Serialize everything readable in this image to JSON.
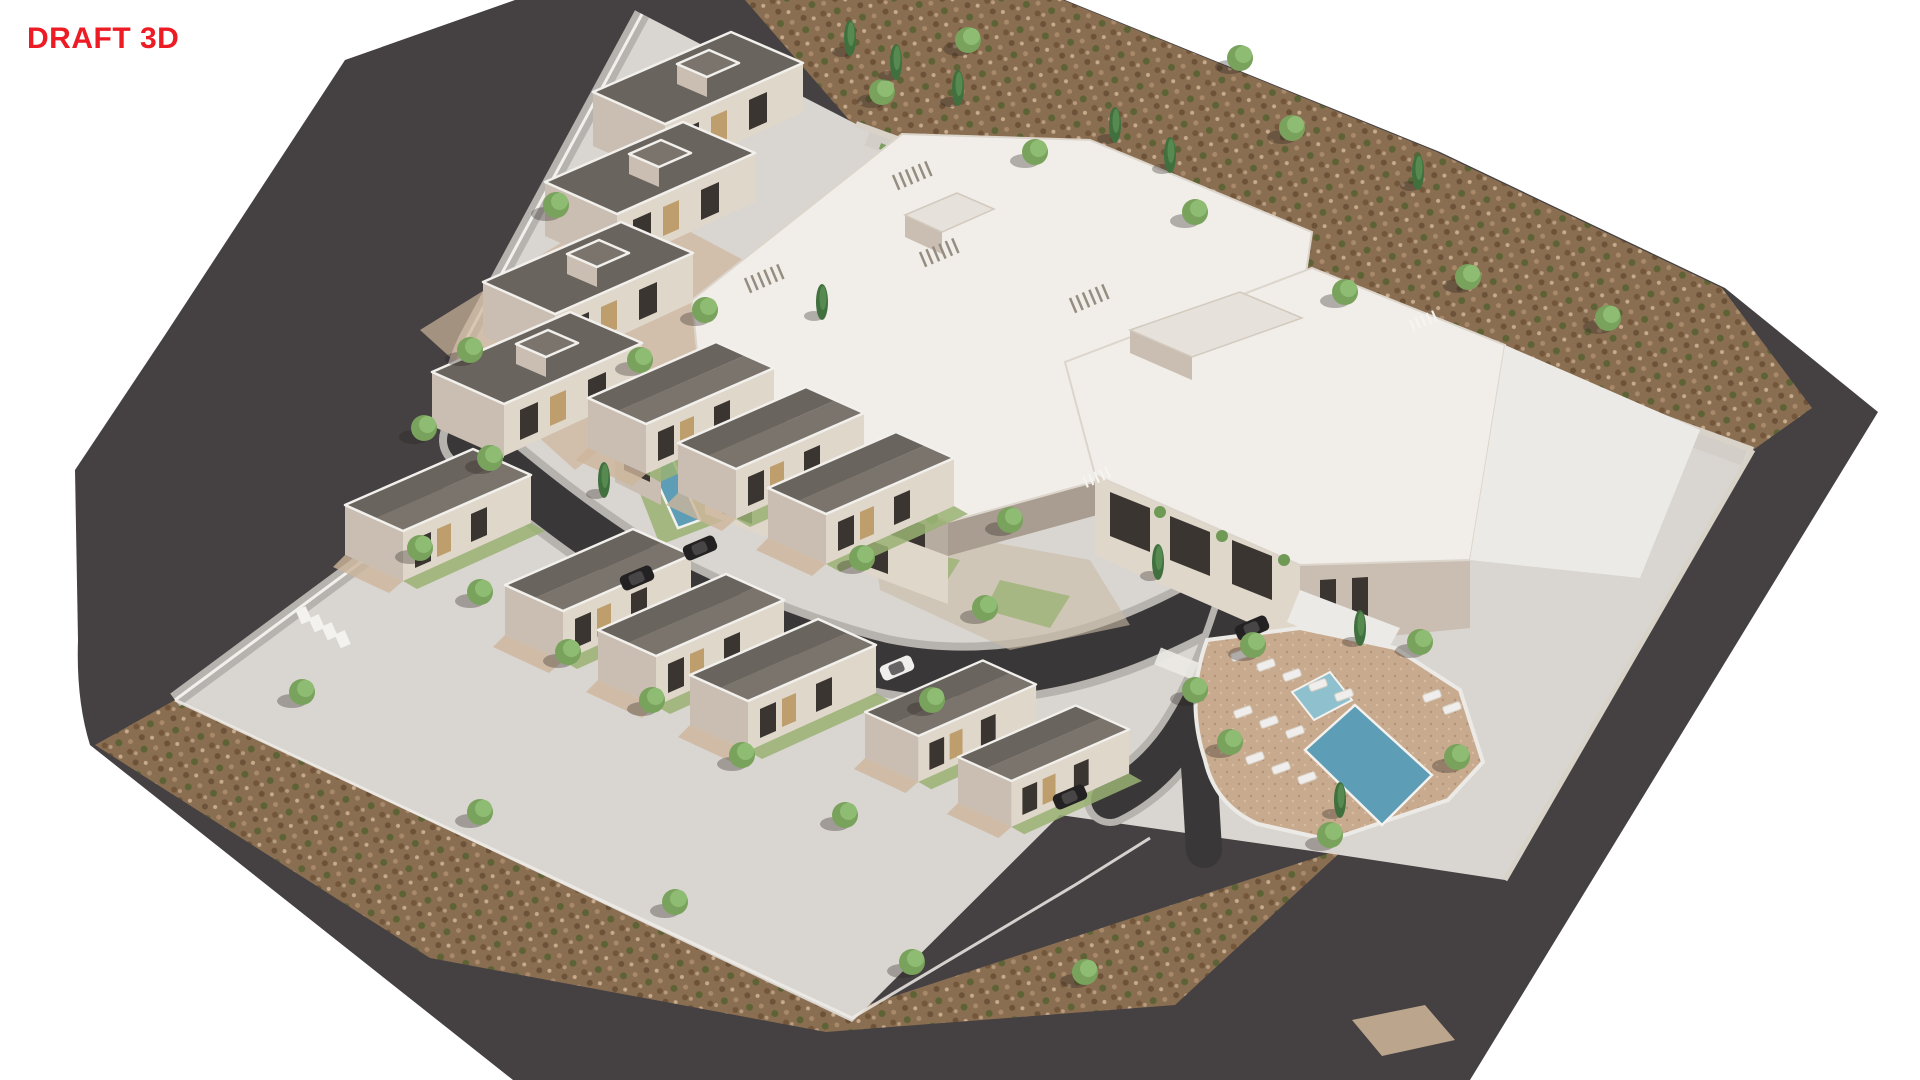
{
  "watermark": {
    "label": "DRAFT 3D",
    "color": "#EC1B24"
  },
  "scene": {
    "type": "3d-architectural-site-render",
    "view": "aerial-axonometric",
    "elements": {
      "apartment_buildings": 2,
      "villas": 13,
      "lap_pools": 3,
      "communal_pool": 1,
      "kids_pool": 1,
      "sun_loungers": 13,
      "cars": 5
    },
    "villas_large": [
      [
        593,
        92
      ],
      [
        545,
        182
      ],
      [
        483,
        282
      ],
      [
        432,
        372
      ]
    ],
    "villas_row": [
      [
        345,
        505,
        1
      ],
      [
        505,
        585,
        1
      ],
      [
        598,
        630,
        1
      ],
      [
        690,
        675,
        1
      ],
      [
        865,
        712,
        0.92
      ],
      [
        958,
        757,
        0.92
      ],
      [
        588,
        398,
        1
      ],
      [
        678,
        443,
        1
      ],
      [
        768,
        488,
        1
      ]
    ],
    "trees": [
      [
        882,
        92
      ],
      [
        1035,
        152
      ],
      [
        1195,
        212
      ],
      [
        1292,
        128
      ],
      [
        1345,
        292
      ],
      [
        1468,
        277
      ],
      [
        1608,
        318
      ],
      [
        1240,
        58
      ],
      [
        968,
        40
      ],
      [
        556,
        205
      ],
      [
        470,
        350
      ],
      [
        424,
        428
      ],
      [
        490,
        458
      ],
      [
        420,
        548
      ],
      [
        480,
        592
      ],
      [
        568,
        652
      ],
      [
        652,
        700
      ],
      [
        742,
        755
      ],
      [
        845,
        815
      ],
      [
        302,
        692
      ],
      [
        480,
        812
      ],
      [
        675,
        902
      ],
      [
        912,
        962
      ],
      [
        1085,
        972
      ],
      [
        1253,
        645
      ],
      [
        1420,
        642
      ],
      [
        1457,
        757
      ],
      [
        1230,
        742
      ],
      [
        1195,
        690
      ],
      [
        985,
        608
      ],
      [
        932,
        700
      ],
      [
        1010,
        520
      ],
      [
        862,
        558
      ],
      [
        1330,
        835
      ],
      [
        705,
        310
      ],
      [
        640,
        360
      ]
    ],
    "cypresses": [
      [
        850,
        38
      ],
      [
        896,
        62
      ],
      [
        1115,
        125
      ],
      [
        1170,
        155
      ],
      [
        1418,
        172
      ],
      [
        958,
        88
      ],
      [
        822,
        302
      ],
      [
        1158,
        562
      ],
      [
        1360,
        628
      ],
      [
        1340,
        800
      ],
      [
        604,
        480
      ]
    ],
    "cars": [
      [
        637,
        578,
        "dark"
      ],
      [
        700,
        548,
        "dark"
      ],
      [
        897,
        668,
        "white"
      ],
      [
        1070,
        797,
        "dark"
      ],
      [
        1252,
        628,
        "dark"
      ]
    ],
    "loungers": [
      [
        1240,
        655
      ],
      [
        1266,
        665
      ],
      [
        1292,
        675
      ],
      [
        1318,
        685
      ],
      [
        1344,
        695
      ],
      [
        1243,
        712
      ],
      [
        1269,
        722
      ],
      [
        1295,
        732
      ],
      [
        1255,
        758
      ],
      [
        1281,
        768
      ],
      [
        1307,
        778
      ],
      [
        1432,
        696
      ],
      [
        1452,
        708
      ]
    ]
  },
  "palette": {
    "asphalt": "#454142",
    "road": "#3a3738",
    "soil": "#8a6e51",
    "parcel": "#d9d5d0",
    "paving": "#eceae6",
    "sidewalk": "#b6b2ae",
    "curb": "#f2f0ec",
    "wall_edge": "#d9d2c8",
    "roof_dark": "#6a645e",
    "roof_mid": "#7b746d",
    "roof_white": "#f1ede8",
    "wall": "#e0d7cb",
    "wall_shade": "#c9beb1",
    "wall_dark": "#a89d90",
    "wood": "#bf9e6e",
    "glass": "#3a3530",
    "water": "#5d9db5",
    "water_light": "#8fc0cd",
    "deck": "#c8aa8e",
    "gravel": "#cdb59b",
    "grass": "#9ab173",
    "hedge": "#6f9a55",
    "tree": "#79a35c",
    "tree_light": "#8fbc73",
    "cypress": "#41703f",
    "cypress_light": "#568a50",
    "shadow": "rgba(40,35,30,0.32)",
    "car_dark": "#242122",
    "car_white": "#efeeec",
    "draft_red": "#EC1B24"
  }
}
